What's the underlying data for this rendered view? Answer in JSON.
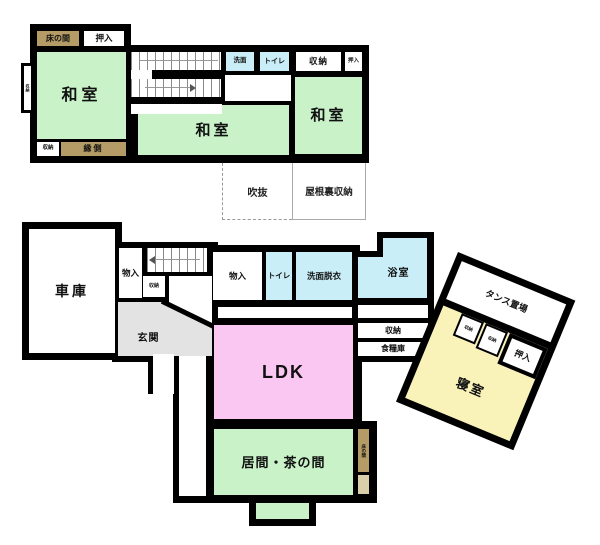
{
  "plan_type": "house-floor-plan",
  "colors": {
    "wall": "#000000",
    "tatami_green": "#c9f2c8",
    "water_cyan": "#c9eef7",
    "ldk_pink": "#f9c7f2",
    "bedroom_yellow": "#f9f3ba",
    "alcove_tan": "#b59b66",
    "alcove_beige": "#d9d0ab",
    "entrance_gray": "#e3e3e3"
  },
  "floor2": {
    "tokonoma": "床の間",
    "oshiire_left": "押入",
    "washitsu_left": "和室",
    "side_closet": "収納",
    "storage_bottom_left": "収納",
    "engawa": "縁側",
    "senmen": "洗面",
    "toilet": "トイレ",
    "storage_top": "収納",
    "oshiire_right": "押入",
    "washitsu_center": "和室",
    "washitsu_right": "和室",
    "fukinuke": "吹抜",
    "yaneura_shuno": "屋根裏収納"
  },
  "floor1": {
    "garage": "車庫",
    "monoire_west": "物入",
    "stair_storage": "収納",
    "genkan": "玄関",
    "monoire": "物入",
    "toilet": "トイレ",
    "senmen_datsui": "洗面脱衣",
    "bathroom": "浴室",
    "shuno": "収納",
    "pantry": "食糧庫",
    "ldk": "LDK",
    "ima_chanoma": "居間・茶の間",
    "tokonoma_side": "床の間",
    "tansu_okiba": "タンス置場",
    "bed_storage_1": "収納",
    "bed_storage_2": "収納",
    "bed_oshiire": "押入",
    "bedroom": "寝室"
  }
}
